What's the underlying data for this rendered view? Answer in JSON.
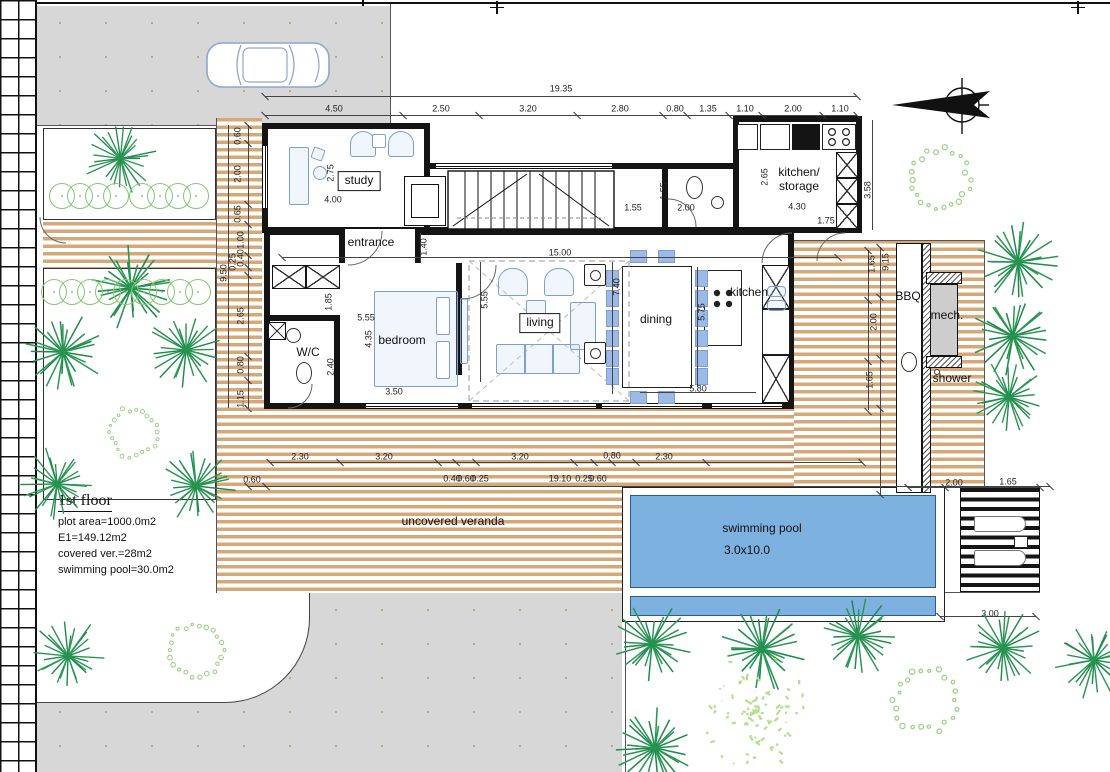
{
  "plan": {
    "floor_title": "1st floor",
    "info_lines": [
      "plot area=1000.0m2",
      "E1=149.12m2",
      "covered ver.=28m2",
      "swimming pool=30.0m2"
    ]
  },
  "colors": {
    "deck_wood": "#d5a977",
    "pool_water": "#7db1e0",
    "paving": "#d7d7d7",
    "tree_dark": "#2a9655",
    "tree_light": "#9cd387",
    "tree_scatter": "#b4e08e",
    "furniture": "#7e9fd4"
  },
  "room_labels": [
    {
      "t": "study",
      "x": 359,
      "y": 181,
      "boxed": 1
    },
    {
      "t": "entrance",
      "x": 371,
      "y": 243
    },
    {
      "t": "bedroom",
      "x": 402,
      "y": 341
    },
    {
      "t": "W/C",
      "x": 308,
      "y": 353
    },
    {
      "t": "living",
      "x": 540,
      "y": 323,
      "boxed": 1
    },
    {
      "t": "dining",
      "x": 656,
      "y": 320
    },
    {
      "t": "kitchen",
      "x": 749,
      "y": 293
    },
    {
      "t": "kitchen/\nstorage",
      "x": 799,
      "y": 180
    },
    {
      "t": "BBQ",
      "x": 908,
      "y": 297
    },
    {
      "t": "mech.",
      "x": 947,
      "y": 316
    },
    {
      "t": "shower",
      "x": 952,
      "y": 379
    },
    {
      "t": "uncovered veranda",
      "x": 453,
      "y": 522
    },
    {
      "t": "swimming pool",
      "x": 762,
      "y": 529
    },
    {
      "t": "3.0x10.0",
      "x": 747,
      "y": 551
    }
  ],
  "dimensions": [
    {
      "t": "19.35",
      "x": 561,
      "y": 89
    },
    {
      "t": "4.50",
      "x": 334,
      "y": 109
    },
    {
      "t": "2.50",
      "x": 441,
      "y": 109
    },
    {
      "t": "3.20",
      "x": 528,
      "y": 109
    },
    {
      "t": "2.80",
      "x": 620,
      "y": 109
    },
    {
      "t": "0.80",
      "x": 675,
      "y": 109
    },
    {
      "t": "1.35",
      "x": 708,
      "y": 109
    },
    {
      "t": "1.10",
      "x": 745,
      "y": 109
    },
    {
      "t": "2.00",
      "x": 793,
      "y": 109
    },
    {
      "t": "1.10",
      "x": 840,
      "y": 109
    },
    {
      "t": "0.60",
      "x": 238,
      "y": 136,
      "v": 1
    },
    {
      "t": "2.00",
      "x": 238,
      "y": 174,
      "v": 1
    },
    {
      "t": "0.65",
      "x": 238,
      "y": 214,
      "v": 1
    },
    {
      "t": "1.00",
      "x": 241,
      "y": 240,
      "v": 1
    },
    {
      "t": "0.40",
      "x": 241,
      "y": 258,
      "v": 1
    },
    {
      "t": "0.25",
      "x": 233,
      "y": 262,
      "v": 1
    },
    {
      "t": "9.50",
      "x": 224,
      "y": 273,
      "v": 1
    },
    {
      "t": "2.65",
      "x": 241,
      "y": 316,
      "v": 1
    },
    {
      "t": "0.80",
      "x": 241,
      "y": 365,
      "v": 1
    },
    {
      "t": "1.15",
      "x": 241,
      "y": 399,
      "v": 1
    },
    {
      "t": "2.75",
      "x": 331,
      "y": 173,
      "v": 1
    },
    {
      "t": "4.00",
      "x": 333,
      "y": 200
    },
    {
      "t": "1.40",
      "x": 424,
      "y": 247,
      "v": 1
    },
    {
      "t": "1.55",
      "x": 633,
      "y": 208
    },
    {
      "t": "1.55",
      "x": 664,
      "y": 191,
      "v": 1
    },
    {
      "t": "2.00",
      "x": 686,
      "y": 208
    },
    {
      "t": "2.65",
      "x": 765,
      "y": 177,
      "v": 1
    },
    {
      "t": "4.30",
      "x": 797,
      "y": 207
    },
    {
      "t": "1.75",
      "x": 826,
      "y": 221
    },
    {
      "t": "3.58",
      "x": 868,
      "y": 190,
      "v": 1
    },
    {
      "t": "15.00",
      "x": 560,
      "y": 253
    },
    {
      "t": "5.55",
      "x": 366,
      "y": 318
    },
    {
      "t": "1.85",
      "x": 329,
      "y": 302,
      "v": 1
    },
    {
      "t": "4.35",
      "x": 369,
      "y": 339,
      "v": 1
    },
    {
      "t": "2.40",
      "x": 331,
      "y": 367,
      "v": 1
    },
    {
      "t": "3.50",
      "x": 394,
      "y": 392
    },
    {
      "t": "5.55",
      "x": 485,
      "y": 300,
      "v": 1
    },
    {
      "t": "7.40",
      "x": 617,
      "y": 287,
      "v": 1
    },
    {
      "t": "5.75",
      "x": 702,
      "y": 312,
      "v": 1
    },
    {
      "t": "5.80",
      "x": 698,
      "y": 389
    },
    {
      "t": "1.65",
      "x": 872,
      "y": 264,
      "v": 1
    },
    {
      "t": "9.15",
      "x": 886,
      "y": 262,
      "v": 1
    },
    {
      "t": "2.00",
      "x": 874,
      "y": 322,
      "v": 1
    },
    {
      "t": "1.65",
      "x": 870,
      "y": 380,
      "v": 1
    },
    {
      "t": "2.00",
      "x": 954,
      "y": 483
    },
    {
      "t": "1.65",
      "x": 1008,
      "y": 482
    },
    {
      "t": "3.00",
      "x": 990,
      "y": 614
    },
    {
      "t": "2.30",
      "x": 300,
      "y": 457
    },
    {
      "t": "3.20",
      "x": 384,
      "y": 457
    },
    {
      "t": "3.20",
      "x": 520,
      "y": 457
    },
    {
      "t": "0.80",
      "x": 612,
      "y": 456
    },
    {
      "t": "2.30",
      "x": 664,
      "y": 457
    },
    {
      "t": "0.60",
      "x": 252,
      "y": 480
    },
    {
      "t": "0.40",
      "x": 452,
      "y": 479
    },
    {
      "t": "0.60",
      "x": 466,
      "y": 479
    },
    {
      "t": "0.25",
      "x": 480,
      "y": 479
    },
    {
      "t": "19.10",
      "x": 560,
      "y": 479
    },
    {
      "t": "0.25",
      "x": 584,
      "y": 479
    },
    {
      "t": "0.60",
      "x": 598,
      "y": 479
    }
  ],
  "dim_lines": [
    {
      "x": 265,
      "y": 96,
      "w": 592,
      "h": 1
    },
    {
      "x": 265,
      "y": 115,
      "w": 592,
      "h": 1
    },
    {
      "x": 248,
      "y": 125,
      "w": 1,
      "h": 283
    },
    {
      "x": 228,
      "y": 125,
      "w": 1,
      "h": 283
    },
    {
      "x": 282,
      "y": 257,
      "w": 556,
      "h": 1
    },
    {
      "x": 270,
      "y": 462,
      "w": 592,
      "h": 1
    },
    {
      "x": 248,
      "y": 486,
      "w": 802,
      "h": 1
    },
    {
      "x": 880,
      "y": 247,
      "w": 1,
      "h": 248
    },
    {
      "x": 868,
      "y": 250,
      "w": 1,
      "h": 160
    },
    {
      "x": 872,
      "y": 120,
      "w": 1,
      "h": 110
    },
    {
      "x": 612,
      "y": 262,
      "w": 1,
      "h": 132
    },
    {
      "x": 480,
      "y": 262,
      "w": 1,
      "h": 120
    },
    {
      "x": 697,
      "y": 267,
      "w": 1,
      "h": 120
    },
    {
      "x": 640,
      "y": 392,
      "w": 116,
      "h": 1
    },
    {
      "x": 908,
      "y": 487,
      "w": 132,
      "h": 1
    },
    {
      "x": 940,
      "y": 616,
      "w": 96,
      "h": 1
    },
    {
      "x": 420,
      "y": 233,
      "w": 1,
      "h": 30
    }
  ],
  "tick_groups": [
    {
      "y": 115,
      "xs": [
        265,
        403,
        479,
        577,
        663,
        687,
        729,
        762,
        823,
        857
      ]
    },
    {
      "y": 96,
      "xs": [
        265,
        857
      ]
    },
    {
      "y": 257,
      "xs": [
        282,
        838
      ]
    },
    {
      "y": 462,
      "xs": [
        270,
        340,
        438,
        456,
        476,
        574,
        594,
        612,
        636,
        706,
        862
      ]
    },
    {
      "y": 486,
      "xs": [
        248,
        266,
        1050
      ]
    },
    {
      "y": 487,
      "xs": [
        908,
        945,
        1040
      ]
    },
    {
      "y": 616,
      "xs": [
        940,
        1036
      ]
    }
  ],
  "vtick_groups": [
    {
      "x": 248,
      "ys": [
        125,
        143,
        204,
        224,
        255,
        267,
        275,
        356,
        380,
        408
      ]
    },
    {
      "x": 880,
      "ys": [
        247,
        297,
        358,
        408,
        494
      ]
    },
    {
      "x": 868,
      "ys": [
        250,
        300,
        361,
        411
      ]
    }
  ],
  "trees": [
    {
      "k": "s",
      "x": 120,
      "y": 158,
      "d": 75
    },
    {
      "k": "s",
      "x": 131,
      "y": 288,
      "d": 88
    },
    {
      "k": "s",
      "x": 63,
      "y": 352,
      "d": 84
    },
    {
      "k": "s",
      "x": 186,
      "y": 350,
      "d": 80
    },
    {
      "k": "s",
      "x": 57,
      "y": 484,
      "d": 76
    },
    {
      "k": "s",
      "x": 196,
      "y": 486,
      "d": 80
    },
    {
      "k": "r",
      "x": 133,
      "y": 432,
      "d": 62
    },
    {
      "k": "s",
      "x": 68,
      "y": 656,
      "d": 78
    },
    {
      "k": "r",
      "x": 196,
      "y": 650,
      "d": 70
    },
    {
      "k": "r",
      "x": 940,
      "y": 180,
      "d": 78
    },
    {
      "k": "s",
      "x": 1018,
      "y": 262,
      "d": 84
    },
    {
      "k": "s",
      "x": 1013,
      "y": 336,
      "d": 84
    },
    {
      "k": "s",
      "x": 1009,
      "y": 397,
      "d": 78
    },
    {
      "k": "s",
      "x": 652,
      "y": 644,
      "d": 82
    },
    {
      "k": "s",
      "x": 762,
      "y": 649,
      "d": 88
    },
    {
      "k": "s",
      "x": 858,
      "y": 636,
      "d": 82
    },
    {
      "k": "s",
      "x": 655,
      "y": 748,
      "d": 86
    },
    {
      "k": "c",
      "x": 755,
      "y": 712,
      "d": 130
    },
    {
      "k": "r",
      "x": 925,
      "y": 700,
      "d": 80
    },
    {
      "k": "s",
      "x": 1003,
      "y": 648,
      "d": 80
    },
    {
      "k": "s",
      "x": 1094,
      "y": 660,
      "d": 80
    }
  ],
  "hedges": [
    {
      "y": 196,
      "xs": [
        62,
        80,
        98,
        116,
        142,
        160,
        178,
        196
      ]
    },
    {
      "y": 292,
      "xs": [
        54,
        72,
        90,
        108,
        126,
        144,
        162,
        180,
        198
      ]
    }
  ]
}
